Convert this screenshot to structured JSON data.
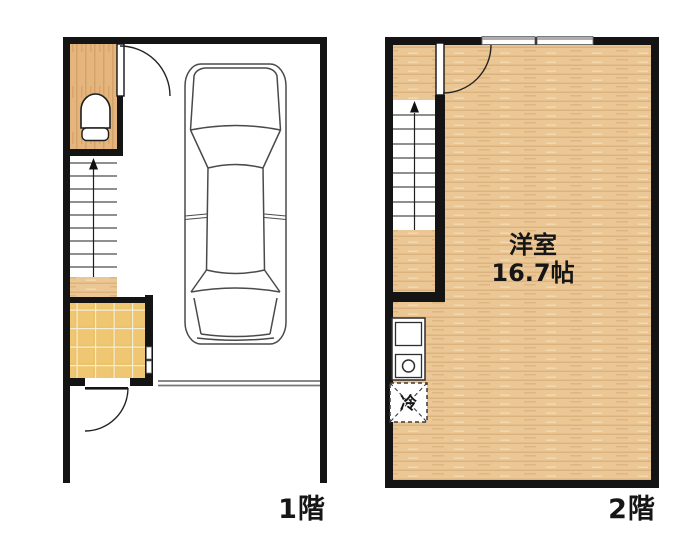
{
  "plan1": {
    "floor_label": "1階"
  },
  "plan2": {
    "floor_label": "2階",
    "room_label": "洋室",
    "room_size": "16.7帖",
    "fridge_label": "冷"
  },
  "colors": {
    "wall": "#141414",
    "wood_base": "#ebc795",
    "wood_stripe": "#d8ab74",
    "tile": "#edc369",
    "tile_grout": "#f3ecd9",
    "shutter_line": "#777777",
    "label_text": "#161616"
  }
}
